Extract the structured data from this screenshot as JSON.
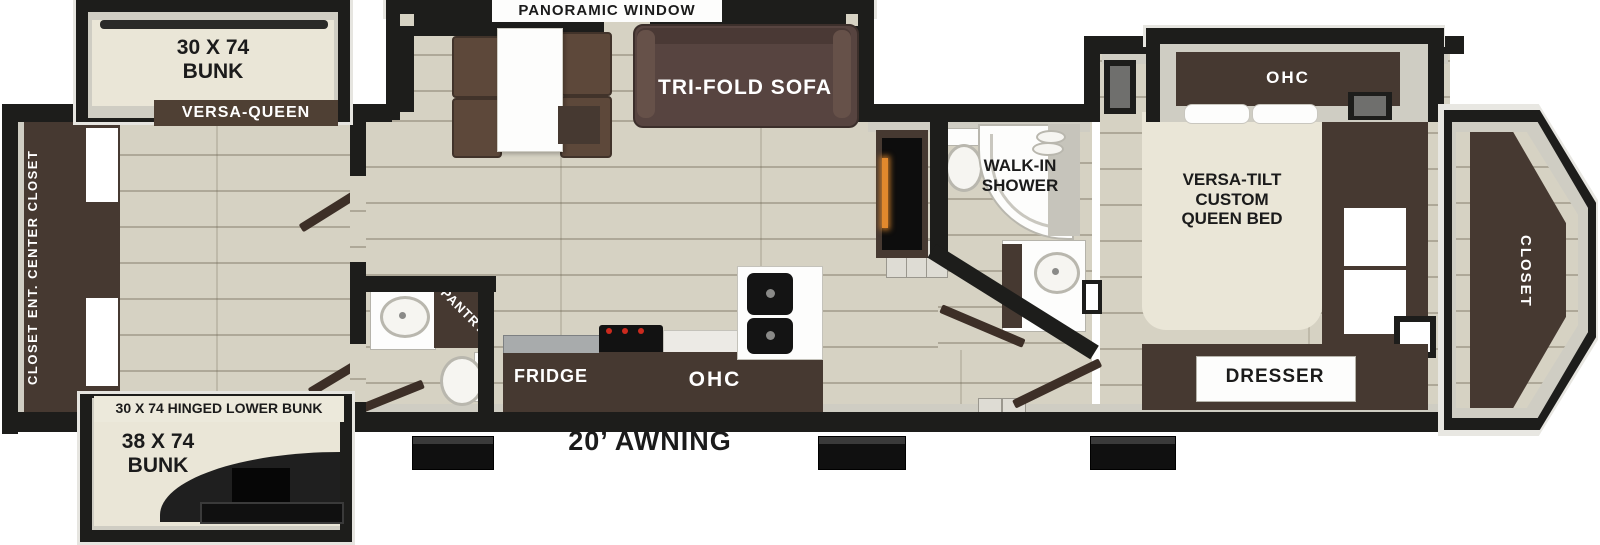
{
  "plan": {
    "exterior": {
      "awning": "20’ AWNING"
    },
    "bunk_room": {
      "upper_bunk": "30 X 74\nBUNK",
      "versa_queen": "VERSA-QUEEN",
      "wall_unit": "CLOSET  ENT. CENTER  CLOSET",
      "hinged_lower_bunk": "30 X 74 HINGED LOWER BUNK",
      "lower_bunk": "38 X 74\nBUNK"
    },
    "living": {
      "panoramic_window": "PANORAMIC WINDOW",
      "tri_fold_sofa": "TRI-FOLD SOFA"
    },
    "kitchen": {
      "pantry": "PANTRY",
      "fridge": "FRIDGE",
      "overhead_cabinet": "OHC"
    },
    "bathroom": {
      "walk_in_shower": "WALK-IN\nSHOWER"
    },
    "bedroom": {
      "overhead_cabinet": "OHC",
      "bed": "VERSA-TILT\nCUSTOM\nQUEEN BED",
      "dresser": "DRESSER",
      "front_closet": "CLOSET"
    },
    "colors": {
      "wall": "#1d1d1b",
      "floor": "#d6d2c3",
      "dark_wood": "#463931",
      "mattress": "#eae6d7",
      "fireplace_glow": "#e2892d"
    }
  }
}
